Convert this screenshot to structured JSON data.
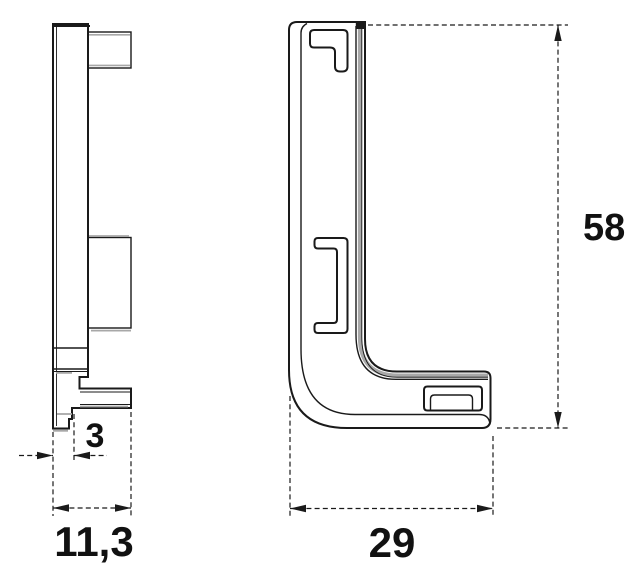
{
  "drawing": {
    "type": "technical-drawing-two-views",
    "dimensions": {
      "offset": {
        "label": "3"
      },
      "depth": {
        "label": "11,3"
      },
      "width": {
        "label": "29"
      },
      "height": {
        "label": "58"
      }
    },
    "colors": {
      "line": "#1a1a1a",
      "edge_shading": "#a8a8a8",
      "text": "#111111",
      "background": "#ffffff"
    }
  }
}
